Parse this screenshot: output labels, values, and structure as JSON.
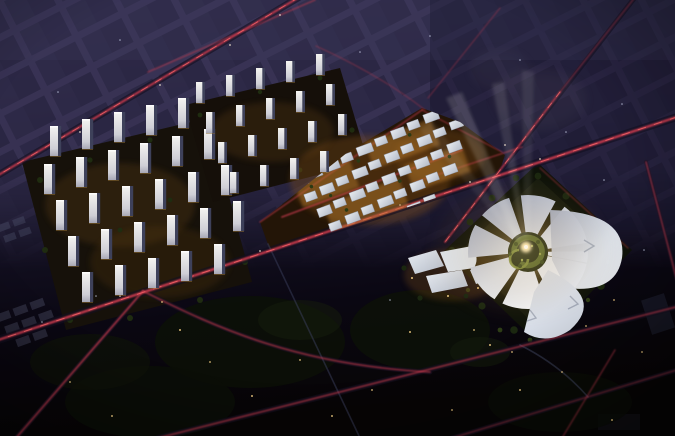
{
  "image": {
    "kind": "aerial night architectural masterplan rendering",
    "view": "oblique bird's-eye view at night",
    "elements": [
      {
        "name": "residential-west-cluster",
        "description": "large grid of lit white residential slab towers with warm courtyard lighting and trees"
      },
      {
        "name": "residential-north-cluster",
        "description": "smaller, more distant rows of lit residential towers"
      },
      {
        "name": "commercial-district",
        "description": "dense low-rise mixed-use blocks with pale roofs and warm golden street lighting"
      },
      {
        "name": "south-halls",
        "description": "large white curved-roof exhibition halls south of the main road"
      },
      {
        "name": "iconic-spiral-landmark",
        "description": "circular petal-roof cultural landmark with terraced green spiral courtyard, glowing core and light beams"
      },
      {
        "name": "road-network",
        "description": "diagonal boulevard grid with red car-light trails and streetlight dots"
      },
      {
        "name": "dark-city-blocks",
        "description": "unlit purple city blocks fading into black ground"
      }
    ],
    "palette": {
      "sky_top": "#38325a",
      "dusk_purple": "#2b2744",
      "block_street": "#3a3456",
      "ground_dark": "#0a0812",
      "ground_black": "#060505",
      "road_trail_red": "#c93a4e",
      "road_trail_bright": "#ff6b6b",
      "street_dot_warm": "#ffd98a",
      "street_dot_cool": "#ffefd8",
      "tower_lit": "#f2f1ee",
      "tower_shade": "#3e415a",
      "roof_pale": "#dde2e8",
      "facade_warm": "#b97b2e",
      "tree_dark": "#1b2710",
      "tree_mid": "#2e3d16",
      "beam_white": "#fffdf4",
      "core_glow": "#ffedba",
      "courtyard_green": "#5b6a2c"
    }
  }
}
